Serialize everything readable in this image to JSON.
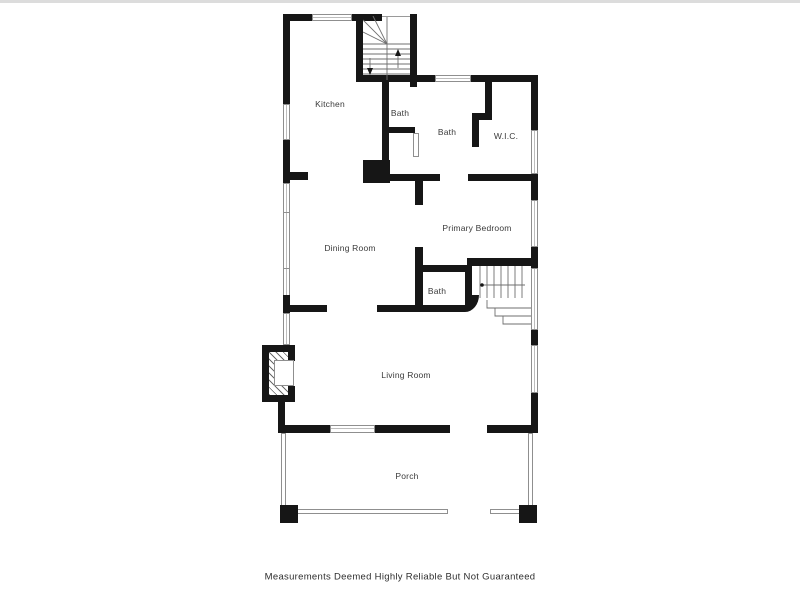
{
  "title": "Floor Plan",
  "disclaimer": "Measurements Deemed Highly Reliable But Not Guaranteed",
  "rooms": [
    {
      "id": "kitchen",
      "label": "Kitchen"
    },
    {
      "id": "bath-upper",
      "label": "Bath"
    },
    {
      "id": "bath-main",
      "label": "Bath"
    },
    {
      "id": "wic",
      "label": "W.I.C."
    },
    {
      "id": "dining-room",
      "label": "Dining Room"
    },
    {
      "id": "primary-bedroom",
      "label": "Primary Bedroom"
    },
    {
      "id": "bath-lower",
      "label": "Bath"
    },
    {
      "id": "living-room",
      "label": "Living Room"
    },
    {
      "id": "porch",
      "label": "Porch"
    }
  ],
  "features": [
    "staircase-up",
    "staircase-down",
    "fireplace",
    "chimney",
    "porch-posts"
  ],
  "colors": {
    "wall": "#161616",
    "window_frame": "#8f8f8f",
    "stair_line": "#6f6f6f",
    "label_text": "#3a3a3a",
    "background": "#ffffff"
  }
}
